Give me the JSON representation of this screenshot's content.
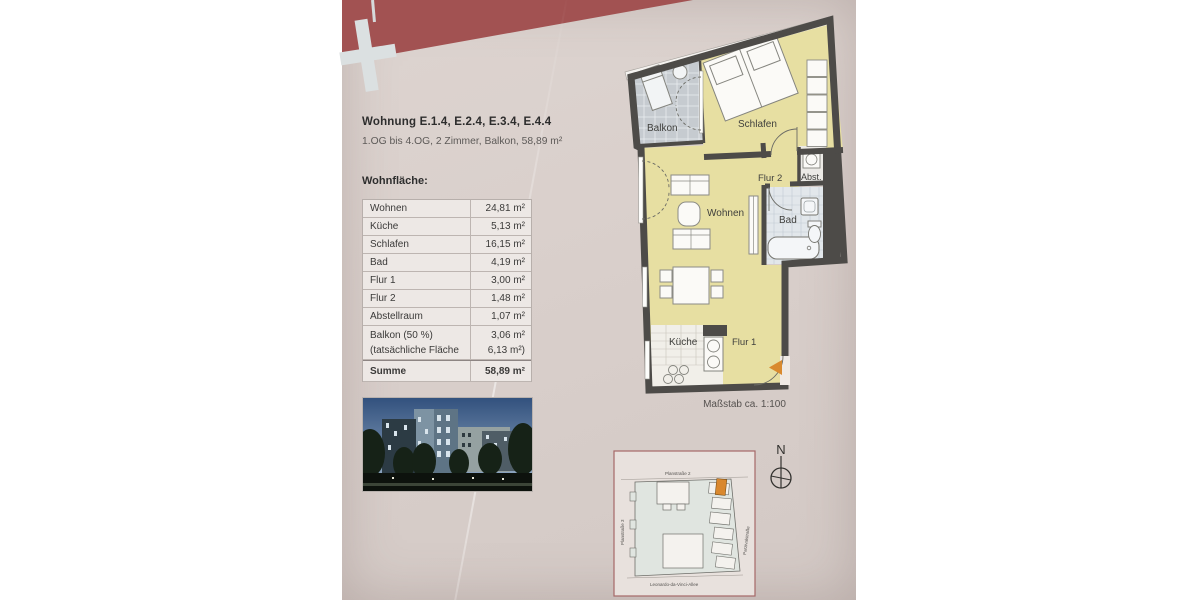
{
  "document": {
    "title": "Wohnung E.1.4, E.2.4, E.3.4, E.4.4",
    "subtitle": "1.OG bis 4.OG, 2 Zimmer, Balkon, 58,89 m²",
    "area_heading": "Wohnfläche:",
    "scale_note": "Maßstab ca. 1:100"
  },
  "area_table": {
    "rows": [
      {
        "label": "Wohnen",
        "value": "24,81 m²"
      },
      {
        "label": "Küche",
        "value": "5,13 m²"
      },
      {
        "label": "Schlafen",
        "value": "16,15 m²"
      },
      {
        "label": "Bad",
        "value": "4,19 m²"
      },
      {
        "label": "Flur 1",
        "value": "3,00 m²"
      },
      {
        "label": "Flur 2",
        "value": "1,48 m²"
      },
      {
        "label": "Abstellraum",
        "value": "1,07 m²"
      },
      {
        "label": "Balkon (50 %)",
        "label_line2": "(tatsächliche Fläche",
        "value": "3,06 m²",
        "value_line2": "6,13 m²)"
      },
      {
        "label": "Summe",
        "value": "58,89 m²"
      }
    ]
  },
  "floor_plan": {
    "rooms": {
      "balkon": "Balkon",
      "schlafen": "Schlafen",
      "flur2": "Flur 2",
      "abstellraum": "Abst.",
      "wohnen": "Wohnen",
      "bad": "Bad",
      "kueche": "Küche",
      "flur1": "Flur 1"
    }
  },
  "site_plan": {
    "street_top": "Planstraße 2",
    "street_left": "Planstraße 3",
    "street_right": "Parzivalstraße",
    "street_bottom": "Leonardo-da-Vinci-Allee",
    "north_label": "N"
  },
  "colors": {
    "page": "#d9cfcb",
    "maroon_band": "#a25252",
    "plan_yellow": "#e7dfa2",
    "balkon_gray": "#c6cbd0",
    "bad_tile": "#e2e7eb",
    "wall": "#4d4b48",
    "entrance_orange": "#d98a2f",
    "site_border": "#a56868"
  }
}
